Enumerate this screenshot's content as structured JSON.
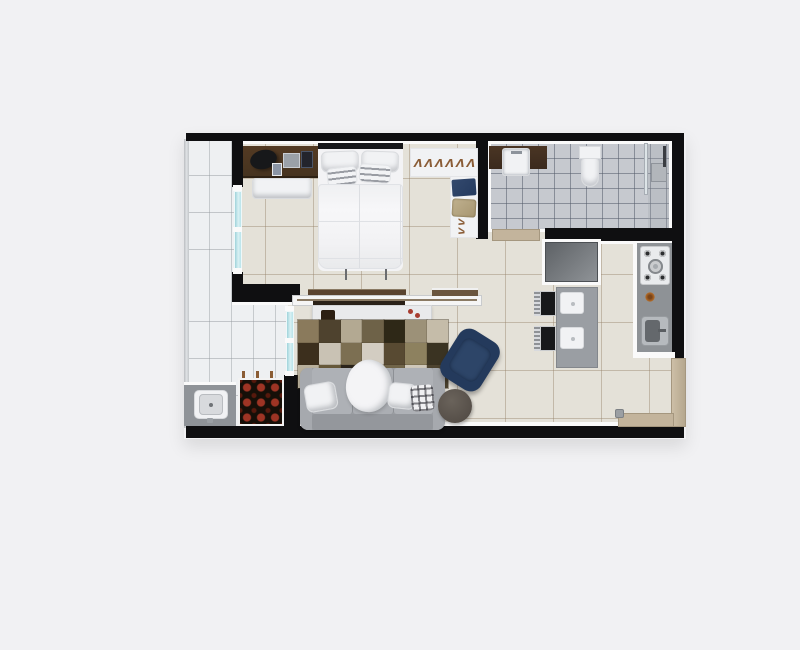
{
  "meta": {
    "scene": "studio-apartment-floor-plan",
    "view": "3d-top-down-render"
  },
  "palette": {
    "page_bg": "#f1f1f3",
    "wall": "#0f0f11",
    "trim": "#fafafa",
    "floor_main": "#e4e1d8",
    "floor_bathroom": "#c6c9cf",
    "floor_balcony": "#eef0f2",
    "glass_door": "#bfe2e8",
    "desk_wood": "#46331f",
    "vanity_wood": "#3b2a1d",
    "door_beige": "#c3b49c",
    "counter_gray": "#8e9296",
    "sofa_gray": "#a4a7ac",
    "armchair_navy": "#243a5c",
    "side_table_brown": "#59524b",
    "garden_red": "#9e3424"
  },
  "rooms": {
    "bedroom": {
      "name": "bedroom",
      "items": [
        "double-bed",
        "headboard",
        "white-pillows",
        "striped-pillows",
        "desk",
        "office-chair",
        "laptop",
        "picture-frame",
        "bench",
        "wardrobe-rail",
        "folded-jeans",
        "folded-bag"
      ]
    },
    "bathroom": {
      "name": "bathroom",
      "items": [
        "wood-vanity",
        "basin-sink",
        "toilet",
        "shower-glass",
        "shower-drain",
        "shower-pipe",
        "door"
      ]
    },
    "kitchen": {
      "name": "kitchen",
      "items": [
        "refrigerator",
        "dining-table",
        "two-plates",
        "two-chairs",
        "gas-cooktop",
        "kitchen-sink",
        "entry-door"
      ]
    },
    "living": {
      "name": "living-room",
      "items": [
        "tv-panel",
        "media-shelf",
        "sideboard",
        "patchwork-rug",
        "sofa",
        "throw-blanket",
        "plaid-pillow",
        "navy-armchair",
        "round-side-table"
      ]
    },
    "balcony": {
      "name": "balcony",
      "items": [
        "glass-door-bedroom",
        "glass-door-living",
        "laundry-tub",
        "vertical-garden"
      ]
    }
  },
  "wardrobe": {
    "hanger_row": "ΛΛΛΛΛΛΛΛ",
    "hanger_mini": "ΛΛΛ"
  },
  "rug": {
    "cols": 7,
    "rows": 3,
    "cells": [
      "#8a7a5c",
      "#4e422e",
      "#b3a992",
      "#6e6248",
      "#2e2817",
      "#9c9178",
      "#c5bca9",
      "#3c2f1d",
      "#c9c2b4",
      "#7c6f52",
      "#d3cdc2",
      "#584a32",
      "#8d815f",
      "#3a3322",
      "#b9b09c",
      "#665839",
      "#2a231a",
      "#a39677",
      "#71654a",
      "#cfc8ba",
      "#4e4430"
    ]
  }
}
